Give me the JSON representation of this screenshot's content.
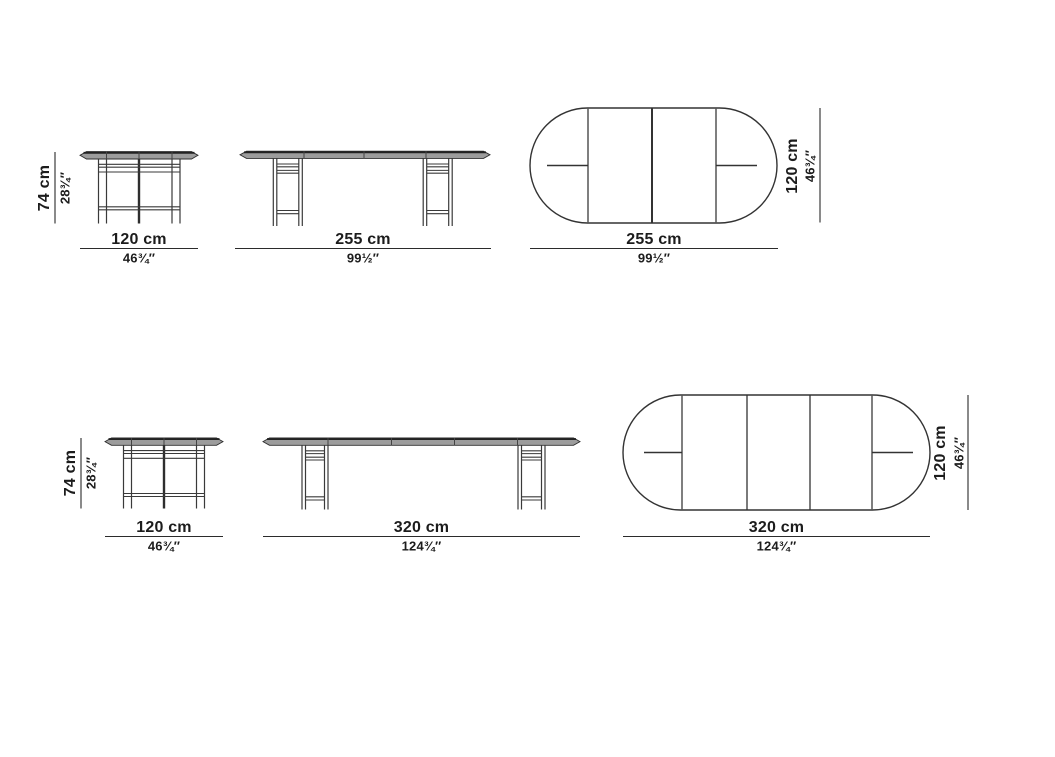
{
  "colors": {
    "line": "#3a3a3a",
    "dim_line": "#2b2b2b",
    "slab_fill": "#9c9c9c",
    "slab_edge": "#222222",
    "tangent_line": "#555555",
    "text": "#1c1c1c",
    "background": "#ffffff"
  },
  "rows": [
    {
      "closed_front": {
        "height_cm": "74 cm",
        "height_in": "28¾″",
        "width_cm": "120 cm",
        "width_in": "46¾″"
      },
      "extended_front": {
        "width_cm": "255 cm",
        "width_in": "99½″"
      },
      "extended_top": {
        "width_cm": "255 cm",
        "width_in": "99½″",
        "depth_cm": "120 cm",
        "depth_in": "46¾″"
      }
    },
    {
      "closed_front": {
        "height_cm": "74 cm",
        "height_in": "28¾″",
        "width_cm": "120 cm",
        "width_in": "46¾″"
      },
      "extended_front": {
        "width_cm": "320 cm",
        "width_in": "124¾″"
      },
      "extended_top": {
        "width_cm": "320 cm",
        "width_in": "124¾″",
        "depth_cm": "120 cm",
        "depth_in": "46¾″"
      }
    }
  ]
}
